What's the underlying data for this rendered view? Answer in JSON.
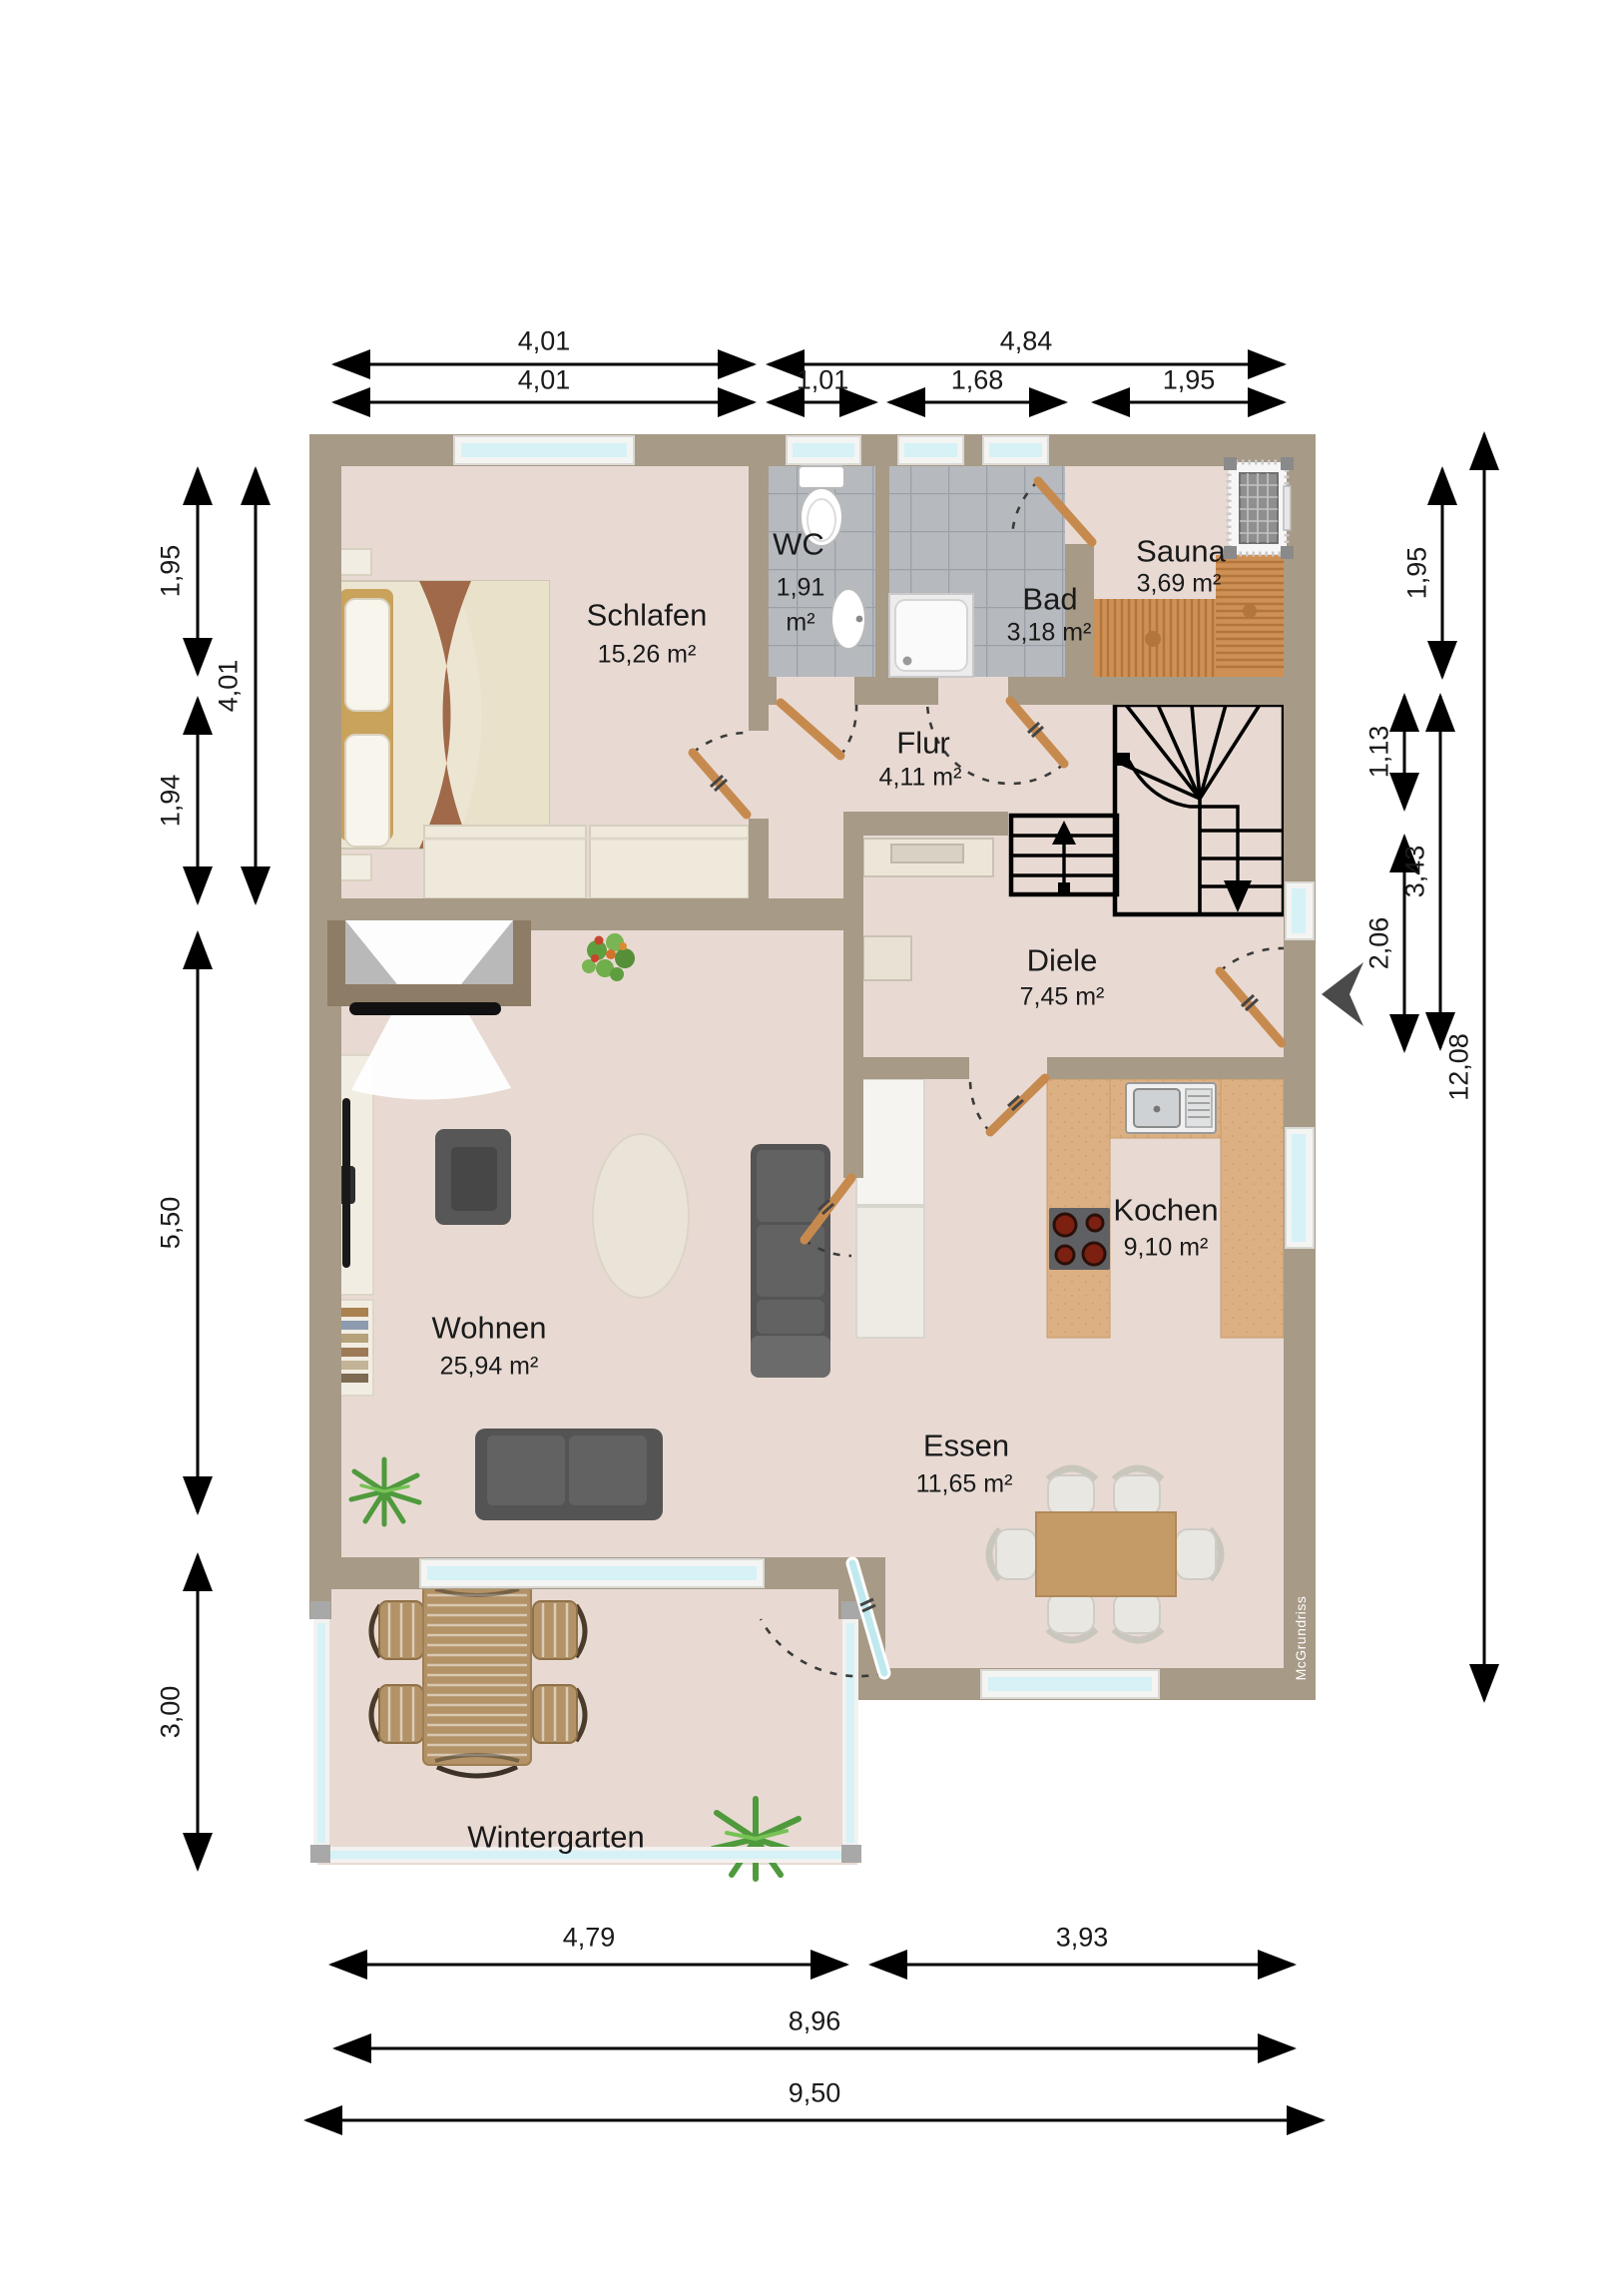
{
  "watermark": "McGrundriss",
  "rooms": {
    "schlafen": {
      "name": "Schlafen",
      "area": "15,26 m²"
    },
    "wc": {
      "name": "WC",
      "area": "1,91",
      "unit": "m²"
    },
    "bad": {
      "name": "Bad",
      "area": "3,18 m²"
    },
    "sauna": {
      "name": "Sauna",
      "area": "3,69 m²"
    },
    "flur": {
      "name": "Flur",
      "area": "4,11 m²"
    },
    "diele": {
      "name": "Diele",
      "area": "7,45 m²"
    },
    "wohnen": {
      "name": "Wohnen",
      "area": "25,94 m²"
    },
    "kochen": {
      "name": "Kochen",
      "area": "9,10 m²"
    },
    "essen": {
      "name": "Essen",
      "area": "11,65 m²"
    },
    "wintergarten": {
      "name": "Wintergarten"
    }
  },
  "dimensions": {
    "top_row1": [
      "4,01",
      "4,84"
    ],
    "top_row2": [
      "4,01",
      "1,01",
      "1,68",
      "1,95"
    ],
    "left": [
      "1,95",
      "4,01",
      "1,94",
      "5,50",
      "3,00"
    ],
    "right": [
      "1,95",
      "1,13",
      "3,43",
      "2,06",
      "12,08"
    ],
    "bottom": [
      "4,79",
      "3,93",
      "8,96",
      "9,50"
    ]
  },
  "colors": {
    "wall": "#a79a86",
    "floor": "#e8dad3",
    "tile": "#b6babf",
    "counter": "#dcb082",
    "wood": "#c78a4e",
    "glass": "#d6f2f6"
  }
}
